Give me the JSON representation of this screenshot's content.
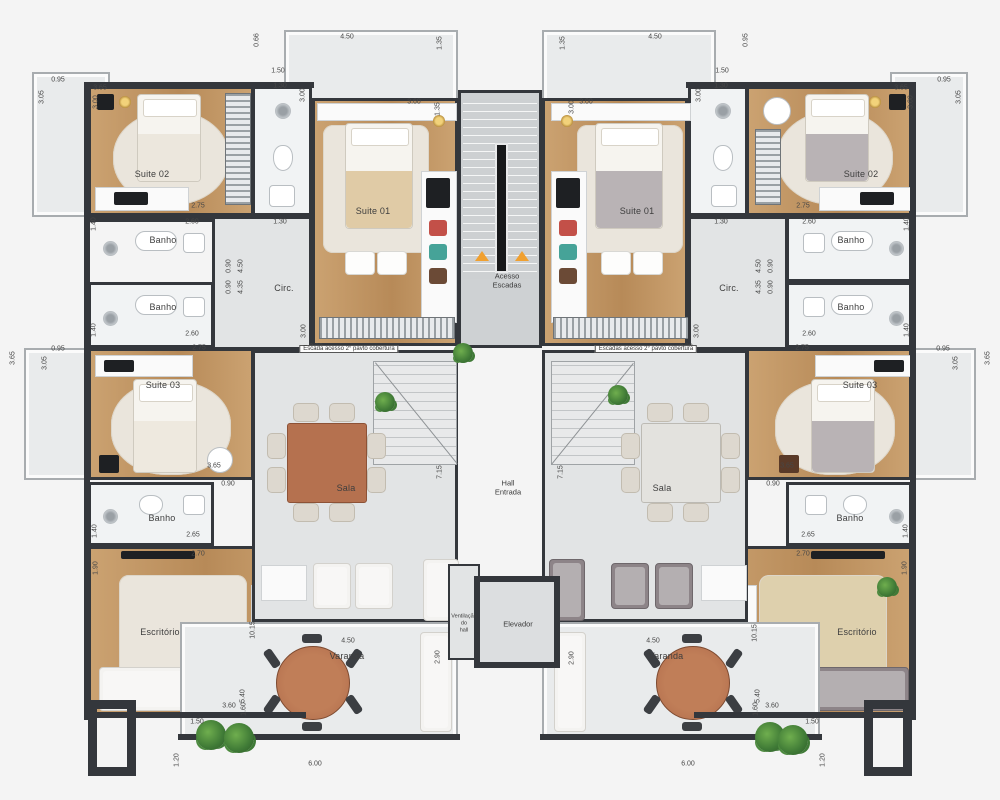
{
  "colors": {
    "wall": "#34373c",
    "wood": "#cba271",
    "wood-dark": "#b78a58",
    "tile": "#f1f3f4",
    "floor": "#e2e4e5",
    "balcony": "#e9ebec",
    "stair": "#ced1d3",
    "accent": "#f0a030",
    "plant": "#3f7a36",
    "table-wood": "#b5714f",
    "rug": "#eae5dc",
    "sofa": "#f4f3f1",
    "sofa-gray": "#8d8488",
    "cushion-red": "#c35048",
    "cushion-teal": "#46a398",
    "cushion-brown": "#6b4a36"
  },
  "core": {
    "stairs": "Acesso\nEscadas",
    "hall": "Hall\nEntrada",
    "vent": "Ventilação\ndo\nhall",
    "elevator": "Elevador"
  },
  "stair_notes": [
    {
      "text": "Escada acesso 2° pavto cobertura",
      "x": 349,
      "y": 349
    },
    {
      "text": "Escadas acesso 2° pavto cobertura",
      "x": 646,
      "y": 349
    }
  ],
  "room_labels": [
    {
      "text": "Suite 02",
      "x": 152,
      "y": 174
    },
    {
      "text": "Suite 01",
      "x": 373,
      "y": 211
    },
    {
      "text": "Circ.",
      "x": 284,
      "y": 288
    },
    {
      "text": "Banho",
      "x": 163,
      "y": 240
    },
    {
      "text": "Banho",
      "x": 163,
      "y": 307
    },
    {
      "text": "Suite 03",
      "x": 163,
      "y": 385
    },
    {
      "text": "Banho",
      "x": 162,
      "y": 518
    },
    {
      "text": "Escritório",
      "x": 160,
      "y": 632
    },
    {
      "text": "Sala",
      "x": 346,
      "y": 488
    },
    {
      "text": "Varanda",
      "x": 347,
      "y": 656
    },
    {
      "text": "Suite 01",
      "x": 637,
      "y": 211
    },
    {
      "text": "Suite 02",
      "x": 861,
      "y": 174
    },
    {
      "text": "Circ.",
      "x": 729,
      "y": 288
    },
    {
      "text": "Banho",
      "x": 851,
      "y": 240
    },
    {
      "text": "Banho",
      "x": 851,
      "y": 307
    },
    {
      "text": "Suite 03",
      "x": 860,
      "y": 385
    },
    {
      "text": "Banho",
      "x": 850,
      "y": 518
    },
    {
      "text": "Escritório",
      "x": 857,
      "y": 632
    },
    {
      "text": "Sala",
      "x": 662,
      "y": 488
    },
    {
      "text": "Varanda",
      "x": 666,
      "y": 656
    }
  ],
  "dimensions": [
    {
      "t": "0.95",
      "x": 58,
      "y": 80,
      "r": 0
    },
    {
      "t": "3.05",
      "x": 42,
      "y": 97,
      "r": 1
    },
    {
      "t": "3.65",
      "x": 100,
      "y": 88,
      "r": 0
    },
    {
      "t": "3.00",
      "x": 96,
      "y": 102,
      "r": 1
    },
    {
      "t": "1.50",
      "x": 278,
      "y": 71,
      "r": 0
    },
    {
      "t": "1.30",
      "x": 280,
      "y": 86,
      "r": 0
    },
    {
      "t": "3.00",
      "x": 303,
      "y": 95,
      "r": 1
    },
    {
      "t": "0.66",
      "x": 257,
      "y": 40,
      "r": 1
    },
    {
      "t": "4.50",
      "x": 347,
      "y": 37,
      "r": 0
    },
    {
      "t": "1.35",
      "x": 440,
      "y": 43,
      "r": 1
    },
    {
      "t": "3.60",
      "x": 414,
      "y": 102,
      "r": 0
    },
    {
      "t": "1.35",
      "x": 438,
      "y": 109,
      "r": 1
    },
    {
      "t": "1.30",
      "x": 280,
      "y": 222,
      "r": 0
    },
    {
      "t": "0.90",
      "x": 229,
      "y": 266,
      "r": 1
    },
    {
      "t": "4.50",
      "x": 241,
      "y": 266,
      "r": 1
    },
    {
      "t": "0.90",
      "x": 229,
      "y": 287,
      "r": 1
    },
    {
      "t": "4.35",
      "x": 241,
      "y": 287,
      "r": 1
    },
    {
      "t": "3.00",
      "x": 304,
      "y": 331,
      "r": 1
    },
    {
      "t": "3.20",
      "x": 316,
      "y": 347,
      "r": 0
    },
    {
      "t": "2.75",
      "x": 198,
      "y": 206,
      "r": 0
    },
    {
      "t": "2.60",
      "x": 192,
      "y": 222,
      "r": 0
    },
    {
      "t": "1.40",
      "x": 94,
      "y": 224,
      "r": 1
    },
    {
      "t": "2.60",
      "x": 192,
      "y": 334,
      "r": 0
    },
    {
      "t": "1.40",
      "x": 94,
      "y": 330,
      "r": 1
    },
    {
      "t": "2.75",
      "x": 199,
      "y": 348,
      "r": 0
    },
    {
      "t": "0.95",
      "x": 58,
      "y": 349,
      "r": 0
    },
    {
      "t": "3.05",
      "x": 45,
      "y": 363,
      "r": 1
    },
    {
      "t": "3.65",
      "x": 13,
      "y": 358,
      "r": 1
    },
    {
      "t": "3.65",
      "x": 214,
      "y": 466,
      "r": 0
    },
    {
      "t": "2.65",
      "x": 193,
      "y": 535,
      "r": 0
    },
    {
      "t": "1.40",
      "x": 95,
      "y": 531,
      "r": 1
    },
    {
      "t": "0.90",
      "x": 228,
      "y": 484,
      "r": 0
    },
    {
      "t": "2.70",
      "x": 198,
      "y": 554,
      "r": 0
    },
    {
      "t": "1.90",
      "x": 96,
      "y": 568,
      "r": 1
    },
    {
      "t": "5.40",
      "x": 243,
      "y": 696,
      "r": 1
    },
    {
      "t": "3.60",
      "x": 229,
      "y": 706,
      "r": 0
    },
    {
      "t": "10.15",
      "x": 253,
      "y": 630,
      "r": 1
    },
    {
      "t": "1.60",
      "x": 244,
      "y": 709,
      "r": 1
    },
    {
      "t": "4.50",
      "x": 348,
      "y": 641,
      "r": 0
    },
    {
      "t": "2.90",
      "x": 438,
      "y": 657,
      "r": 1
    },
    {
      "t": "1.50",
      "x": 197,
      "y": 722,
      "r": 0
    },
    {
      "t": "1.20",
      "x": 177,
      "y": 760,
      "r": 1
    },
    {
      "t": "6.00",
      "x": 315,
      "y": 764,
      "r": 0
    },
    {
      "t": "7.15",
      "x": 440,
      "y": 472,
      "r": 1
    },
    {
      "t": "1.35",
      "x": 563,
      "y": 43,
      "r": 1
    },
    {
      "t": "4.50",
      "x": 655,
      "y": 37,
      "r": 0
    },
    {
      "t": "0.95",
      "x": 746,
      "y": 40,
      "r": 1
    },
    {
      "t": "1.50",
      "x": 722,
      "y": 71,
      "r": 0
    },
    {
      "t": "1.30",
      "x": 721,
      "y": 86,
      "r": 0
    },
    {
      "t": "3.00",
      "x": 699,
      "y": 95,
      "r": 1
    },
    {
      "t": "3.65",
      "x": 901,
      "y": 88,
      "r": 0
    },
    {
      "t": "3.00",
      "x": 911,
      "y": 102,
      "r": 1
    },
    {
      "t": "0.95",
      "x": 944,
      "y": 80,
      "r": 0
    },
    {
      "t": "3.05",
      "x": 959,
      "y": 97,
      "r": 1
    },
    {
      "t": "3.00",
      "x": 572,
      "y": 107,
      "r": 1
    },
    {
      "t": "3.00",
      "x": 586,
      "y": 102,
      "r": 0
    },
    {
      "t": "1.30",
      "x": 721,
      "y": 222,
      "r": 0
    },
    {
      "t": "4.50",
      "x": 759,
      "y": 266,
      "r": 1
    },
    {
      "t": "0.90",
      "x": 771,
      "y": 266,
      "r": 1
    },
    {
      "t": "4.35",
      "x": 759,
      "y": 287,
      "r": 1
    },
    {
      "t": "0.90",
      "x": 771,
      "y": 287,
      "r": 1
    },
    {
      "t": "3.00",
      "x": 697,
      "y": 331,
      "r": 1
    },
    {
      "t": "3.20",
      "x": 686,
      "y": 347,
      "r": 0
    },
    {
      "t": "2.75",
      "x": 803,
      "y": 206,
      "r": 0
    },
    {
      "t": "2.60",
      "x": 809,
      "y": 222,
      "r": 0
    },
    {
      "t": "1.40",
      "x": 907,
      "y": 224,
      "r": 1
    },
    {
      "t": "2.60",
      "x": 809,
      "y": 334,
      "r": 0
    },
    {
      "t": "1.40",
      "x": 907,
      "y": 330,
      "r": 1
    },
    {
      "t": "2.75",
      "x": 802,
      "y": 348,
      "r": 0
    },
    {
      "t": "0.95",
      "x": 943,
      "y": 349,
      "r": 0
    },
    {
      "t": "3.05",
      "x": 956,
      "y": 363,
      "r": 1
    },
    {
      "t": "3.65",
      "x": 988,
      "y": 358,
      "r": 1
    },
    {
      "t": "3.65",
      "x": 787,
      "y": 466,
      "r": 0
    },
    {
      "t": "2.65",
      "x": 808,
      "y": 535,
      "r": 0
    },
    {
      "t": "1.40",
      "x": 906,
      "y": 531,
      "r": 1
    },
    {
      "t": "0.90",
      "x": 773,
      "y": 484,
      "r": 0
    },
    {
      "t": "2.70",
      "x": 803,
      "y": 554,
      "r": 0
    },
    {
      "t": "1.90",
      "x": 905,
      "y": 568,
      "r": 1
    },
    {
      "t": "5.40",
      "x": 758,
      "y": 696,
      "r": 1
    },
    {
      "t": "3.60",
      "x": 772,
      "y": 706,
      "r": 0
    },
    {
      "t": "10.15",
      "x": 755,
      "y": 633,
      "r": 1
    },
    {
      "t": "1.60",
      "x": 756,
      "y": 709,
      "r": 1
    },
    {
      "t": "4.50",
      "x": 653,
      "y": 641,
      "r": 0
    },
    {
      "t": "2.90",
      "x": 572,
      "y": 658,
      "r": 1
    },
    {
      "t": "1.50",
      "x": 812,
      "y": 722,
      "r": 0
    },
    {
      "t": "1.20",
      "x": 823,
      "y": 760,
      "r": 1
    },
    {
      "t": "6.00",
      "x": 688,
      "y": 764,
      "r": 0
    },
    {
      "t": "7.15",
      "x": 561,
      "y": 472,
      "r": 1
    }
  ]
}
